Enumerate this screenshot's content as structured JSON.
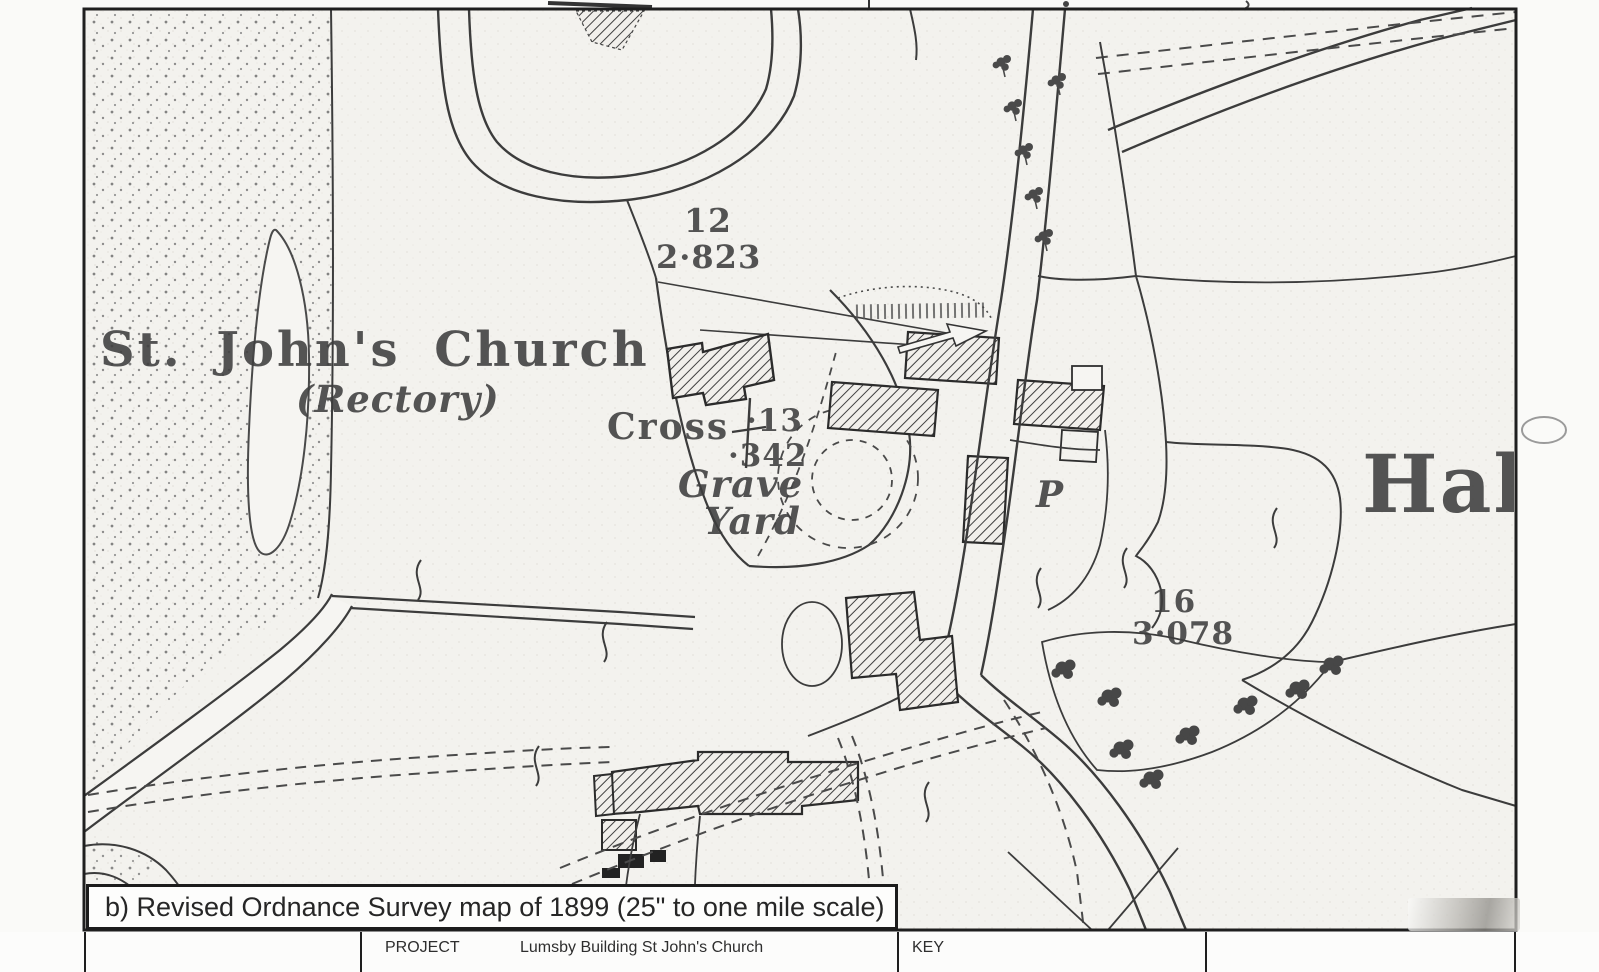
{
  "page": {
    "paper_color": "#fafaf8",
    "map_paper_color": "#f3f2ee",
    "ink_color": "#3c3c3c"
  },
  "map": {
    "title_note": "Revised Ordnance Survey map, St John's Church area",
    "labels": {
      "parcel12_number": "12",
      "parcel12_acreage": "2·823",
      "church_name": "St. John's Church",
      "rectory": "(Rectory)",
      "cross": "Cross",
      "parcel13_number": "·13",
      "parcel13_acreage": "·342",
      "grave": "Grave",
      "yard": "Yard",
      "pump": "P",
      "parcel16_number": "16",
      "parcel16_acreage": "3·078",
      "hall_clipped": "Hal"
    }
  },
  "caption": {
    "text": "b) Revised Ordnance Survey map of 1899 (25\" to one mile scale)"
  },
  "footer": {
    "project_label": "PROJECT",
    "project_value": "Lumsby Building St John's Church",
    "key_label": "KEY"
  }
}
